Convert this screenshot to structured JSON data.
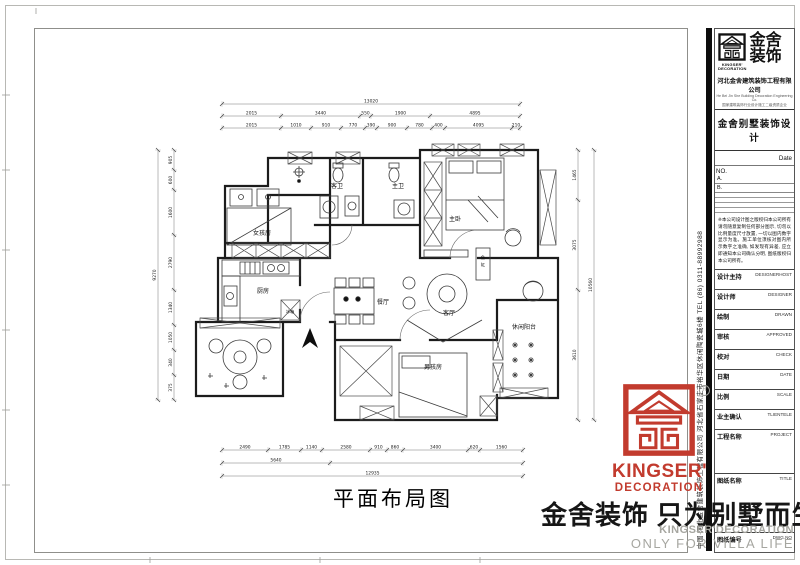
{
  "sheet": {
    "drawing_title": "平面布局图",
    "slogan_cn": "金舍装饰 只为别墅而生。",
    "slogan_en_1": "KINGSER'DECORATION",
    "slogan_en_2": "ONLY FOR VILLA LIFE",
    "side_company_text": "中国·河北金舍建筑装饰工程有限公司  河北省石家庄市裕华区休闲陶瓷城6楼  TEL (86) 0311-88992988"
  },
  "title_block": {
    "brand_cn_1": "金舍",
    "brand_cn_2": "装饰",
    "brand_en_1": "KINGSER'",
    "brand_en_2": "DECORATION",
    "company": "河北金舍建筑装饰工程有限公司",
    "company_en": "He Bei Jin She Building Decoration Engineering Co.",
    "company_sub": "国家建筑装饰行业设计施工二级资质企业",
    "product_line": "金舍别墅装饰设计",
    "date_label": "Date",
    "no_label": "NO.",
    "rev_a": "A.",
    "rev_b": "B.",
    "disclaimer": "※本公司设计图之版权归本公司所有 请勿随意复制任何部分图示, 切勿以比例量度尺寸放置, 一切以图内数字显示为准。施工单位须核对图内所示数字之准确, 如发现有异差, 应立即通知本公司确认分明, 图纸版权归本公司所有。",
    "rows": [
      {
        "label": "设计主持",
        "en": "DESIGNERHOST"
      },
      {
        "label": "设计师",
        "en": "DESIGNER"
      },
      {
        "label": "绘制",
        "en": "DRAWN"
      },
      {
        "label": "审核",
        "en": "APPROVED"
      },
      {
        "label": "校对",
        "en": "CHECK"
      },
      {
        "label": "日期",
        "en": "DATE"
      },
      {
        "label": "比例",
        "en": "SCALE"
      },
      {
        "label": "业主确认",
        "en": "TLIENTELE"
      },
      {
        "label": "工程名称",
        "en": "PROJECT"
      },
      {
        "label": "图纸名称",
        "en": "TITLE"
      },
      {
        "label": "图纸编号",
        "en": "DWG.NO"
      }
    ]
  },
  "footer_logo": {
    "brand": "KINGSER'",
    "sub": "DECORATION",
    "registered": "R"
  },
  "plan": {
    "rooms": [
      {
        "label": "女孩房"
      },
      {
        "label": "客卫"
      },
      {
        "label": "主卫"
      },
      {
        "label": "主卧"
      },
      {
        "label": "厨房"
      },
      {
        "label": "冰箱"
      },
      {
        "label": "餐厅"
      },
      {
        "label": "客厅"
      },
      {
        "label": "鱼缸"
      },
      {
        "label": "休闲阳台"
      },
      {
        "label": "男孩房"
      }
    ],
    "dimension_runs": [
      {
        "o": "h",
        "pos": 104,
        "stops": [
          222,
          520
        ],
        "labels": [
          "13020"
        ]
      },
      {
        "o": "h",
        "pos": 116,
        "stops": [
          222,
          281,
          360,
          371,
          430,
          520
        ],
        "labels": [
          "2015",
          "3440",
          "550",
          "1900",
          "4895"
        ]
      },
      {
        "o": "h",
        "pos": 128,
        "stops": [
          222,
          281,
          311,
          341,
          365,
          377,
          407,
          432,
          445,
          512,
          520
        ],
        "labels": [
          "2015",
          "1010",
          "910",
          "770",
          "390",
          "900",
          "780",
          "400",
          "4095",
          "210"
        ]
      },
      {
        "o": "h",
        "pos": 450,
        "stops": [
          222,
          268,
          301,
          322,
          370,
          387,
          403,
          468,
          480,
          523
        ],
        "labels": [
          "2490",
          "1785",
          "1140",
          "2580",
          "910",
          "860",
          "3400",
          "620",
          "1560"
        ]
      },
      {
        "o": "h",
        "pos": 463,
        "stops": [
          222,
          330,
          523
        ],
        "labels": [
          "5640",
          ""
        ]
      },
      {
        "o": "h",
        "pos": 476,
        "stops": [
          222,
          523
        ],
        "labels": [
          "12935"
        ]
      },
      {
        "o": "v",
        "pos": 174,
        "stops": [
          150,
          170,
          190,
          235,
          290,
          325,
          350,
          375,
          400
        ],
        "labels": [
          "905",
          "600",
          "1600",
          "2790",
          "1340",
          "1050",
          "340",
          "375"
        ]
      },
      {
        "o": "v",
        "pos": 158,
        "stops": [
          150,
          400
        ],
        "labels": [
          "9270"
        ]
      },
      {
        "o": "v",
        "pos": 578,
        "stops": [
          150,
          200,
          290,
          420
        ],
        "labels": [
          "1465",
          "3075",
          "3610"
        ]
      },
      {
        "o": "v",
        "pos": 594,
        "stops": [
          150,
          420
        ],
        "labels": [
          "10560"
        ]
      }
    ]
  },
  "colors": {
    "brand_red": "#c23b2e",
    "gray_text": "#a6a6a0"
  }
}
